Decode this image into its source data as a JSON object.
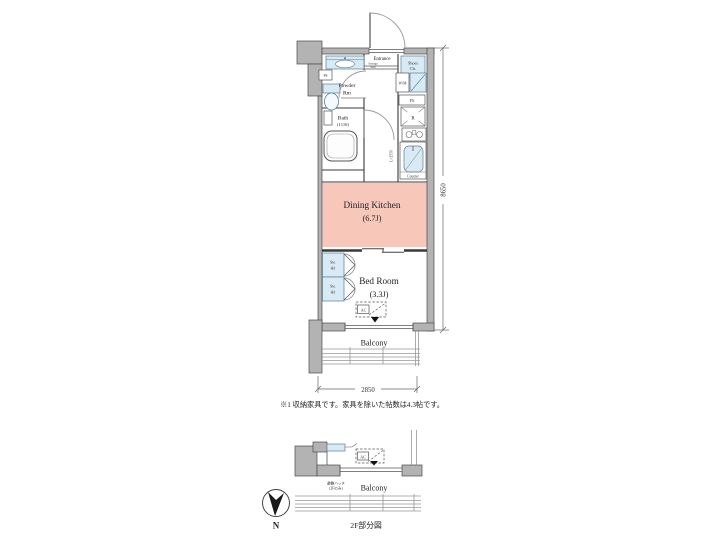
{
  "colors": {
    "wall_gray": "#b3b3b3",
    "dining_kitchen_pink": "#f7c7ba",
    "fixture_blue": "#d8eaf4"
  },
  "plan": {
    "entrance": {
      "label": "Entrance",
      "sub_line1": "Storage",
      "sub_line2": "Seat"
    },
    "shoes_closet": {
      "line1": "Shoes",
      "line2": "Cls."
    },
    "powder_room": {
      "line1": "Powder",
      "line2": "Rm"
    },
    "bath": {
      "name": "Bath",
      "size": "(1116)"
    },
    "washing_machine": {
      "label": "W/M"
    },
    "pipe_space_left": {
      "label": "PS"
    },
    "pipe_space_right": {
      "label": "PS"
    },
    "refrigerator": {
      "label": "R"
    },
    "kitchen": {
      "counter_label": "Counter",
      "counter_length": "L=2550"
    },
    "dining_kitchen": {
      "name": "Dining Kitchen",
      "size": "(6.7J)",
      "fill": "#f7c7ba"
    },
    "storage_upper": {
      "line1": "Sto.",
      "line2": "※1"
    },
    "storage_lower": {
      "line1": "Sto.",
      "line2": "※1"
    },
    "bed_room": {
      "name": "Bed Room",
      "size": "(3.3J)"
    },
    "ac_unit": {
      "label": "AC"
    },
    "balcony": {
      "label": "Balcony"
    },
    "dimensions": {
      "width": "2850",
      "height": "8650"
    },
    "note": "※1 収納家具です。家具を除いた帖数は4.3帖です。"
  },
  "lower_plan": {
    "balcony": {
      "label": "Balcony"
    },
    "ac_unit": {
      "label": "AC"
    },
    "hatch": {
      "line1": "避難ハッチ",
      "line2": "(2Fのみ)"
    },
    "caption": "2F部分図",
    "compass": {
      "label": "N"
    }
  }
}
